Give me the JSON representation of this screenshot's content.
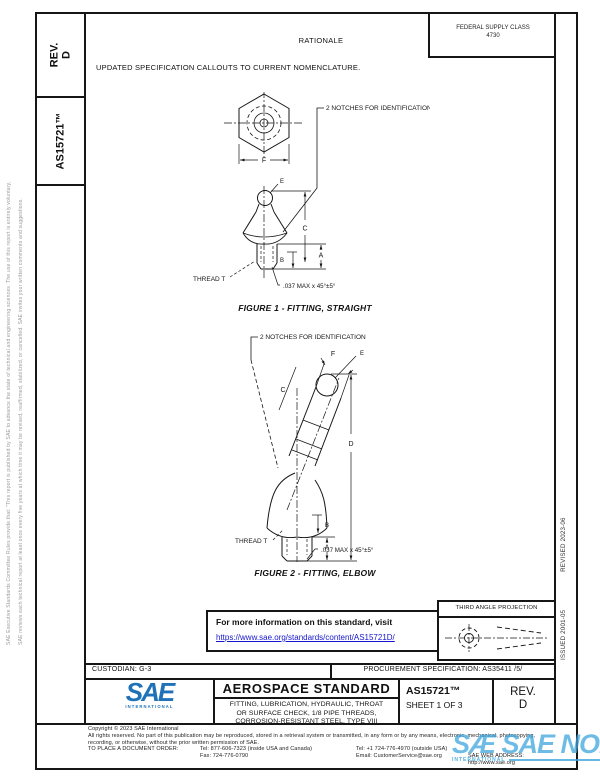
{
  "margins": {
    "left_outer": "SAE Executive Standards Committee Rules provide that: \"This report is published by SAE to advance the state of technical and engineering sciences. The use of this report is entirely voluntary, and its applicability and suitability for any particular use, including any patent infringement arising therefrom, is the sole responsibility of the user.\"",
    "left_inner": "SAE reviews each technical report at least once every five years at which time it may be revised, reaffirmed, stabilized, or cancelled. SAE invites your written comments and suggestions.",
    "issued": "ISSUED 2001-05",
    "revised": "REVISED 2023-06"
  },
  "sidebar": {
    "rev_label": "REV.",
    "rev_value": "D",
    "doc_number": "AS15721™"
  },
  "header": {
    "fsc_line1": "FEDERAL SUPPLY CLASS",
    "fsc_line2": "4730",
    "rationale_title": "RATIONALE",
    "rationale_text": "UPDATED SPECIFICATION CALLOUTS TO CURRENT NOMENCLATURE."
  },
  "figure1": {
    "caption": "FIGURE 1 - FITTING, STRAIGHT",
    "notches": "2 NOTCHES FOR IDENTIFICATION",
    "thread": "THREAD T",
    "chamfer": ".037 MAX x 45°±5°",
    "dim_f": "F",
    "dim_e": "E",
    "dim_c": "C",
    "dim_a": "A",
    "dim_b": "B"
  },
  "figure2": {
    "caption": "FIGURE 2 - FITTING, ELBOW",
    "notches": "2 NOTCHES FOR IDENTIFICATION",
    "thread": "THREAD T",
    "chamfer": ".037 MAX x 45°±5°",
    "dim_f": "F",
    "dim_e": "E",
    "dim_c": "C",
    "dim_d": "D",
    "dim_a": "A",
    "dim_b": "B"
  },
  "info_box": {
    "line1": "For more information on this standard, visit",
    "link": "https://www.sae.org/standards/content/AS15721D/"
  },
  "projection": {
    "label": "THIRD ANGLE PROJECTION"
  },
  "title_block": {
    "custodian": "CUSTODIAN: G-3",
    "procurement": "PROCUREMENT SPECIFICATION: AS35411 /5/",
    "standard_type": "AEROSPACE STANDARD",
    "title_line1": "FITTING, LUBRICATION, HYDRAULIC, THROAT",
    "title_line2": "OR SURFACE CHECK, 1/8 PIPE THREADS,",
    "title_line3": "CORROSION-RESISTANT STEEL, TYPE VIII",
    "doc_number": "AS15721™",
    "sheet": "SHEET 1 OF 3",
    "rev_label": "REV.",
    "rev_value": "D",
    "logo_text": "SAE",
    "logo_sub": "INTERNATIONAL"
  },
  "footer": {
    "copyright": "Copyright © 2023 SAE International",
    "rights1": "All rights reserved. No part of this publication may be reproduced, stored in a retrieval system or transmitted, in any form or by any means, electronic, mechanical, photocopying,",
    "rights2": "recording, or otherwise, without the prior written permission of SAE.",
    "order_label": "TO PLACE A DOCUMENT ORDER:",
    "tel1": "Tel: 877-606-7323 (inside USA and Canada)",
    "tel2": "Tel: +1 724-776-4970 (outside USA)",
    "fax": "Fax: 724-776-0790",
    "email": "Email: CustomerService@sae.org",
    "web": "SAE WEB ADDRESS: http://www.sae.org"
  },
  "watermark": {
    "text": "SÆ SAE NORM",
    "sub": "INTERNATIONAL"
  },
  "colors": {
    "sae_blue": "#1f72b8",
    "link_blue": "#1515cf",
    "watermark_blue": "#3ea6dc"
  }
}
